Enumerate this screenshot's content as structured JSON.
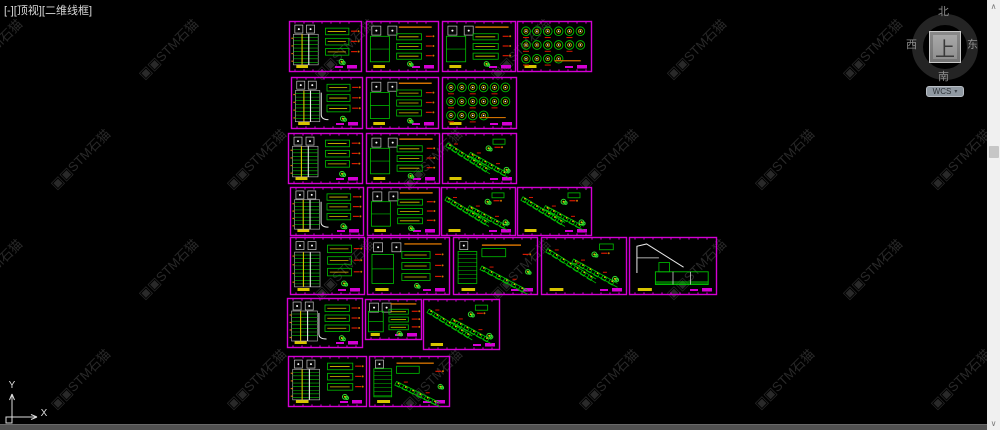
{
  "viewport_label": "[-][顶视][二维线框]",
  "viewcube": {
    "north": "北",
    "south": "南",
    "west": "西",
    "east": "东",
    "top": "上",
    "wcs_label": "WCS",
    "dropdown_glyph": "▾"
  },
  "ucs": {
    "x_label": "X",
    "y_label": "Y"
  },
  "scrollbar": {
    "up_glyph": "∧",
    "down_glyph": "∨"
  },
  "watermark": {
    "prefix": "▣▣",
    "text": "STM石猫",
    "color": "#292929"
  },
  "colors": {
    "background": "#000000",
    "sheet_border": "#d400d4",
    "green": "#00c000",
    "bright_green": "#2ee02e",
    "yellow": "#d8c400",
    "white": "#dcdcdc",
    "red": "#d81800",
    "orange": "#d07000",
    "magenta": "#d400d4",
    "ucs_line": "#dcdcdc"
  },
  "sheets": [
    {
      "x": 289,
      "y": 21,
      "w": 73,
      "h": 51,
      "kind": "table"
    },
    {
      "x": 366,
      "y": 21,
      "w": 73,
      "h": 51,
      "kind": "panel"
    },
    {
      "x": 442,
      "y": 21,
      "w": 74,
      "h": 51,
      "kind": "panel"
    },
    {
      "x": 517,
      "y": 21,
      "w": 75,
      "h": 51,
      "kind": "circles"
    },
    {
      "x": 291,
      "y": 77,
      "w": 72,
      "h": 52,
      "kind": "table"
    },
    {
      "x": 366,
      "y": 77,
      "w": 73,
      "h": 52,
      "kind": "panel"
    },
    {
      "x": 442,
      "y": 77,
      "w": 75,
      "h": 52,
      "kind": "circles"
    },
    {
      "x": 288,
      "y": 133,
      "w": 75,
      "h": 51,
      "kind": "table"
    },
    {
      "x": 366,
      "y": 133,
      "w": 74,
      "h": 51,
      "kind": "panel"
    },
    {
      "x": 442,
      "y": 133,
      "w": 75,
      "h": 51,
      "kind": "stairs"
    },
    {
      "x": 290,
      "y": 187,
      "w": 74,
      "h": 49,
      "kind": "table"
    },
    {
      "x": 367,
      "y": 187,
      "w": 73,
      "h": 49,
      "kind": "panel"
    },
    {
      "x": 441,
      "y": 187,
      "w": 75,
      "h": 49,
      "kind": "stairs"
    },
    {
      "x": 517,
      "y": 187,
      "w": 75,
      "h": 49,
      "kind": "stairs"
    },
    {
      "x": 290,
      "y": 237,
      "w": 75,
      "h": 58,
      "kind": "table"
    },
    {
      "x": 367,
      "y": 237,
      "w": 83,
      "h": 58,
      "kind": "panel"
    },
    {
      "x": 453,
      "y": 237,
      "w": 85,
      "h": 58,
      "kind": "mixed"
    },
    {
      "x": 541,
      "y": 237,
      "w": 86,
      "h": 58,
      "kind": "stairs"
    },
    {
      "x": 629,
      "y": 237,
      "w": 88,
      "h": 58,
      "kind": "section"
    },
    {
      "x": 287,
      "y": 298,
      "w": 76,
      "h": 50,
      "kind": "table"
    },
    {
      "x": 365,
      "y": 299,
      "w": 57,
      "h": 41,
      "kind": "panel"
    },
    {
      "x": 423,
      "y": 299,
      "w": 77,
      "h": 51,
      "kind": "stairs"
    },
    {
      "x": 288,
      "y": 356,
      "w": 79,
      "h": 51,
      "kind": "table"
    },
    {
      "x": 369,
      "y": 356,
      "w": 81,
      "h": 51,
      "kind": "mixed"
    }
  ]
}
